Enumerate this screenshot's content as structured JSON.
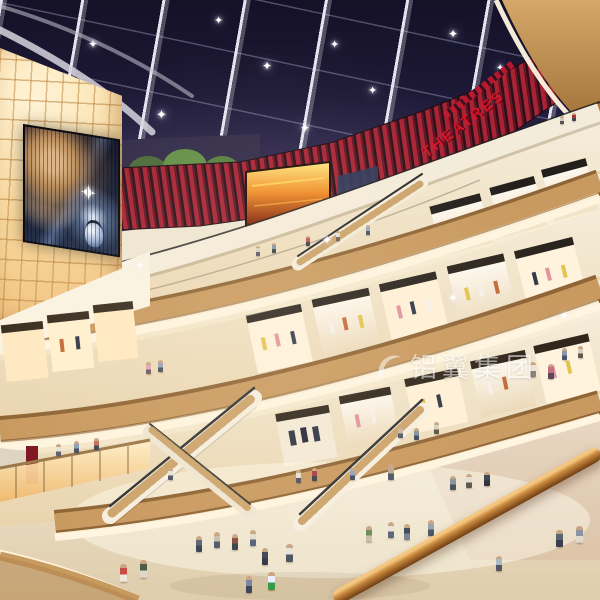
{
  "scene": {
    "theatre_sign": "THEATRES",
    "watermark_text": "铝翼集团",
    "icons": {
      "sparkle": "✦"
    },
    "palette": {
      "skylight_navy": "#1d1936",
      "beam_white": "#e3e1ee",
      "theatre_red": "#a82334",
      "sign_red": "#d6122a",
      "wood_tan": "#c1905a",
      "cove_white": "#fff6e0",
      "amber_wall_glow": "#fbdda4",
      "cream": "#f0e8d8",
      "floor_beige": "#e7dbc4"
    }
  }
}
